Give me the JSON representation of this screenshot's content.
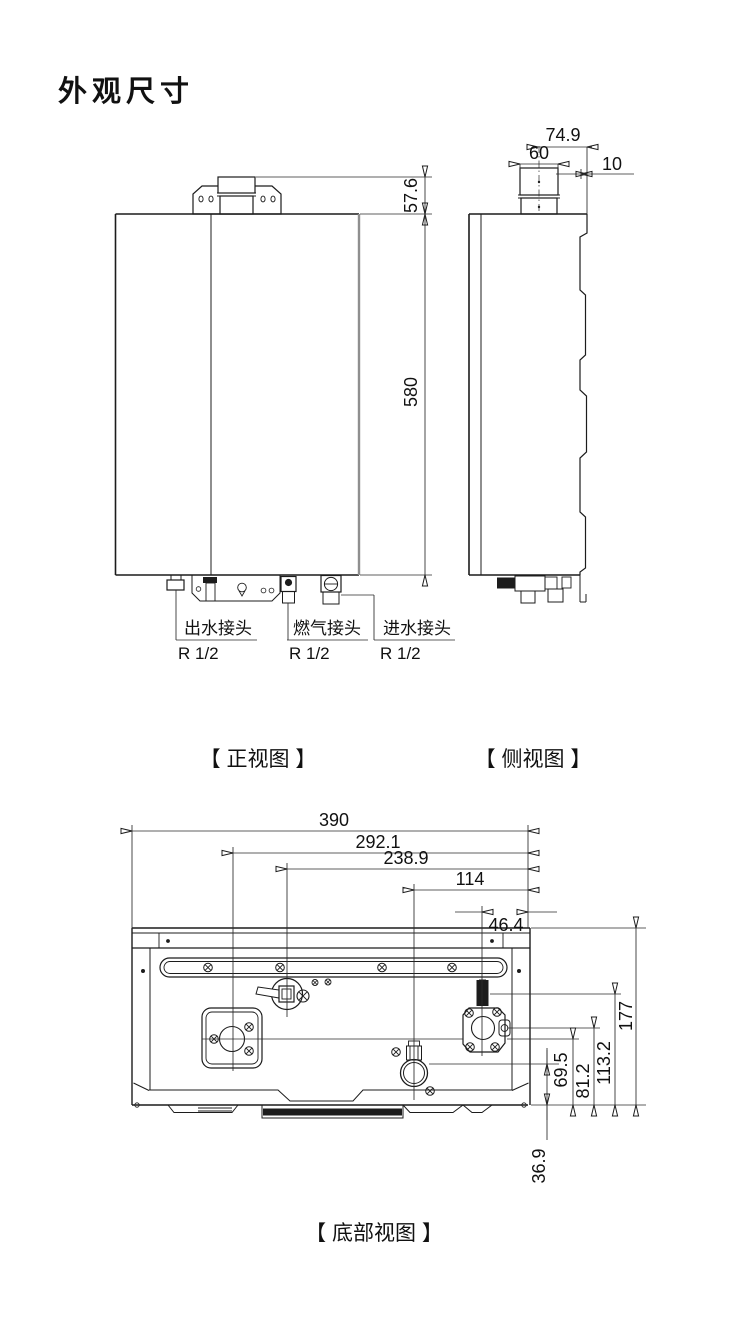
{
  "title": "外观尺寸",
  "captions": {
    "front": "【 正视图 】",
    "side": "【 侧视图 】",
    "bottom": "【 底部视图 】"
  },
  "connectors": [
    {
      "name": "出水接头",
      "thread": "R 1/2"
    },
    {
      "name": "燃气接头",
      "thread": "R 1/2"
    },
    {
      "name": "进水接头",
      "thread": "R 1/2"
    }
  ],
  "dims": {
    "front": {
      "flue": "57.6",
      "height": "580"
    },
    "side": {
      "offset": "74.9",
      "width": "60",
      "step": "10"
    },
    "bottom_h": {
      "total": "390",
      "a": "292.1",
      "b": "238.9",
      "c": "114",
      "d": "46.4"
    },
    "bottom_v": {
      "total": "177",
      "a": "113.2",
      "b": "81.2",
      "c": "69.5",
      "d": "36.9"
    }
  }
}
